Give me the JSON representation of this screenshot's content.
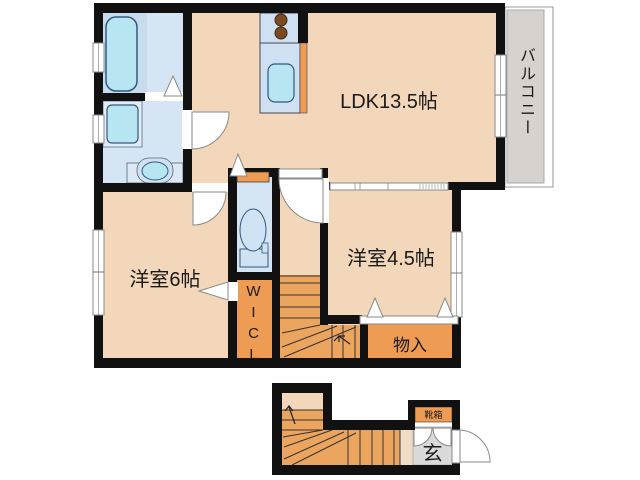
{
  "plan": {
    "rooms": {
      "ldk": {
        "label": "LDK13.5帖"
      },
      "balcony": {
        "label": "バルコニー"
      },
      "bedroom6": {
        "label": "洋室6帖"
      },
      "bedroom45": {
        "label": "洋室4.5帖"
      },
      "storage": {
        "label": "物入"
      },
      "wicl": {
        "label": "WICL"
      },
      "genkan": {
        "label": "玄"
      },
      "shoebox": {
        "label": "靴箱"
      }
    },
    "colors": {
      "wall": "#111111",
      "room": "#f3d7ba",
      "wet_area": "#d5e5f3",
      "fixture": "#b7e6f2",
      "stairs": "#eca55e",
      "closet": "#ee9b54",
      "balcony": "#d7d2cd",
      "genkan": "#dadada",
      "burner": "#7a4a21"
    }
  }
}
